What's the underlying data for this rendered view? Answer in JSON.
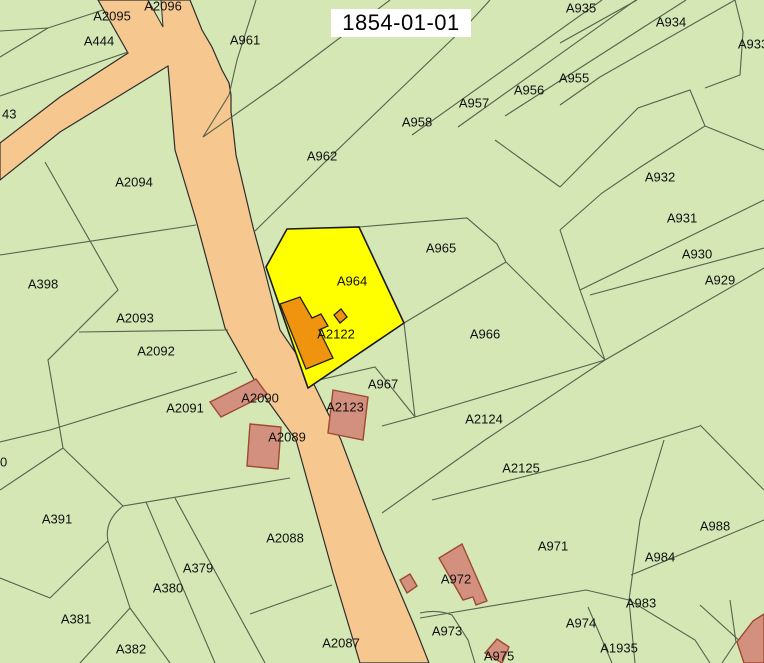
{
  "title": {
    "date": "1854-01-01"
  },
  "map": {
    "width": 764,
    "height": 663,
    "colors": {
      "background_parcel": "#d5e7b5",
      "boundary_line": "#56624c",
      "road_fill": "#f6c88f",
      "road_stroke": "#2e2e2e",
      "highlight_parcel_fill": "#ffff00",
      "highlight_parcel_stroke": "#1a1a1a",
      "orange_building_fill": "#f0930f",
      "orange_building_stroke": "#222222",
      "salmon_building_fill": "#d4907f",
      "salmon_building_stroke": "#9c4a33",
      "label_color": "#111111",
      "title_bg": "#ffffff",
      "title_color": "#000000"
    },
    "roads": [
      {
        "name": "main-road",
        "points": "98,0 190,0 202,30 212,47 222,70 229,83 231,95 231,112 233,128 236,155 253,227 262,260 280,330 306,368 341,440 382,550 414,625 429,663 360,663 333,573 296,440 260,390 225,328 196,220 175,150 168,66 60,132 0,180 0,143 60,97 128,53"
      }
    ],
    "road_wedge": {
      "name": "road-fork-wedge",
      "points": "148,0 161,0 163,27"
    },
    "highlight_parcel": {
      "id": "A964",
      "points": "287,229 359,227 404,323 308,388 266,267"
    },
    "orange_buildings": [
      {
        "points": "280,304 300,297 312,318 321,314 328,326 319,330 333,358 306,369"
      },
      {
        "points": "334,315 341,309 347,317 340,323"
      }
    ],
    "salmon_buildings": [
      {
        "points": "210,402 256,379 267,394 221,417"
      },
      {
        "points": "250,424 281,427 278,469 247,466"
      },
      {
        "points": "333,390 368,397 363,440 328,433"
      },
      {
        "points": "462,544 487,601 476,605 473,597 463,600 439,558"
      },
      {
        "points": "400,580 410,574 417,586 407,593"
      },
      {
        "points": "497,639 509,647 502,663 485,653"
      },
      {
        "points": "753,621 764,614 764,663 744,663 737,642"
      }
    ],
    "boundaries": [
      "M0,31 L48,28 L103,10",
      "M0,57 L48,28",
      "M0,96 L128,52",
      "M256,0 L237,60 L229,95 L203,137",
      "M203,137 L280,83 L390,0",
      "M255,231 L327,160 L470,22 L490,0",
      "M359,227 L467,218 L497,244 L506,262",
      "M404,323 L506,262",
      "M506,262 L605,360",
      "M382,426 L415,417 L605,360",
      "M404,323 L415,417",
      "M310,382 L375,367 L415,417",
      "M382,513 L485,440",
      "M485,440 L605,360",
      "M432,500 L589,460 L700,426",
      "M560,187 L638,108 L690,90 L705,126 L764,150",
      "M705,126 L642,166 L602,193 L560,230",
      "M560,230 L580,290 L605,360",
      "M495,140 L560,187",
      "M412,135 L602,0",
      "M458,127 L636,0",
      "M505,116 L686,0",
      "M560,105 L600,77 L735,0",
      "M560,43 L637,0",
      "M705,88 L740,75 L743,32 L735,0",
      "M580,290 L764,200",
      "M590,295 L764,248",
      "M605,360 L764,268",
      "M664,440 L640,520 L629,600 L635,663",
      "M631,575 L764,520",
      "M700,425 L764,490",
      "M629,600 L695,640 L710,663",
      "M700,605 L764,663",
      "M730,600 L736,642 L722,663",
      "M420,618 L586,590 L629,600",
      "M420,613 Q437,609 452,615 L468,640 L475,663",
      "M588,607 L612,663",
      "M45,162 L118,290 L48,360 L63,448",
      "M0,255 L196,225",
      "M79,332 L228,330",
      "M0,442 L50,430 L237,372",
      "M123,506 L290,478",
      "M63,448 L123,506 Q104,521 108,541 L130,608",
      "M130,608 L80,663",
      "M130,608 L170,663",
      "M146,502 L215,663",
      "M175,498 L265,663",
      "M250,614 L332,585",
      "M0,578 L50,598 L108,541",
      "M0,490 L63,448"
    ],
    "labels": [
      {
        "id": "A2095",
        "x": 112,
        "y": 16
      },
      {
        "id": "A2096",
        "x": 163,
        "y": 6
      },
      {
        "id": "A444",
        "x": 99,
        "y": 41
      },
      {
        "id": "A961",
        "x": 245,
        "y": 40
      },
      {
        "id": "A935",
        "x": 581,
        "y": 8
      },
      {
        "id": "A934",
        "x": 671,
        "y": 22
      },
      {
        "id": "A933",
        "x": 753,
        "y": 44
      },
      {
        "id": "A955",
        "x": 574,
        "y": 78
      },
      {
        "id": "A956",
        "x": 529,
        "y": 90
      },
      {
        "id": "A957",
        "x": 474,
        "y": 103
      },
      {
        "id": "A958",
        "x": 417,
        "y": 122
      },
      {
        "id": "A962",
        "x": 322,
        "y": 156
      },
      {
        "id": "A932",
        "x": 660,
        "y": 177
      },
      {
        "id": "A931",
        "x": 682,
        "y": 218
      },
      {
        "id": "43",
        "x": 2,
        "y": 114,
        "anchor": "start"
      },
      {
        "id": "A2094",
        "x": 134,
        "y": 182
      },
      {
        "id": "A965",
        "x": 441,
        "y": 248
      },
      {
        "id": "A930",
        "x": 697,
        "y": 254
      },
      {
        "id": "A929",
        "x": 720,
        "y": 280
      },
      {
        "id": "A398",
        "x": 43,
        "y": 284
      },
      {
        "id": "A964",
        "x": 352,
        "y": 281
      },
      {
        "id": "A2093",
        "x": 135,
        "y": 318
      },
      {
        "id": "A966",
        "x": 485,
        "y": 334
      },
      {
        "id": "A2122",
        "x": 336,
        "y": 334
      },
      {
        "id": "A2092",
        "x": 156,
        "y": 351
      },
      {
        "id": "A967",
        "x": 383,
        "y": 384
      },
      {
        "id": "A2091",
        "x": 185,
        "y": 408
      },
      {
        "id": "A2090",
        "x": 260,
        "y": 398
      },
      {
        "id": "A2123",
        "x": 345,
        "y": 407
      },
      {
        "id": "A2124",
        "x": 484,
        "y": 419
      },
      {
        "id": "A2089",
        "x": 287,
        "y": 437
      },
      {
        "id": "A2125",
        "x": 521,
        "y": 468
      },
      {
        "id": "0",
        "x": 0,
        "y": 462,
        "anchor": "start"
      },
      {
        "id": "A391",
        "x": 57,
        "y": 519
      },
      {
        "id": "A988",
        "x": 715,
        "y": 526
      },
      {
        "id": "A2088",
        "x": 285,
        "y": 538
      },
      {
        "id": "A971",
        "x": 553,
        "y": 546
      },
      {
        "id": "A984",
        "x": 660,
        "y": 557
      },
      {
        "id": "A379",
        "x": 198,
        "y": 568
      },
      {
        "id": "A972",
        "x": 456,
        "y": 579
      },
      {
        "id": "A380",
        "x": 168,
        "y": 588
      },
      {
        "id": "A983",
        "x": 641,
        "y": 603
      },
      {
        "id": "A381",
        "x": 76,
        "y": 619
      },
      {
        "id": "A974",
        "x": 581,
        "y": 623
      },
      {
        "id": "A973",
        "x": 447,
        "y": 631
      },
      {
        "id": "A2087",
        "x": 341,
        "y": 643
      },
      {
        "id": "A382",
        "x": 131,
        "y": 649
      },
      {
        "id": "A1935",
        "x": 619,
        "y": 648
      },
      {
        "id": "A975",
        "x": 499,
        "y": 656
      }
    ]
  }
}
